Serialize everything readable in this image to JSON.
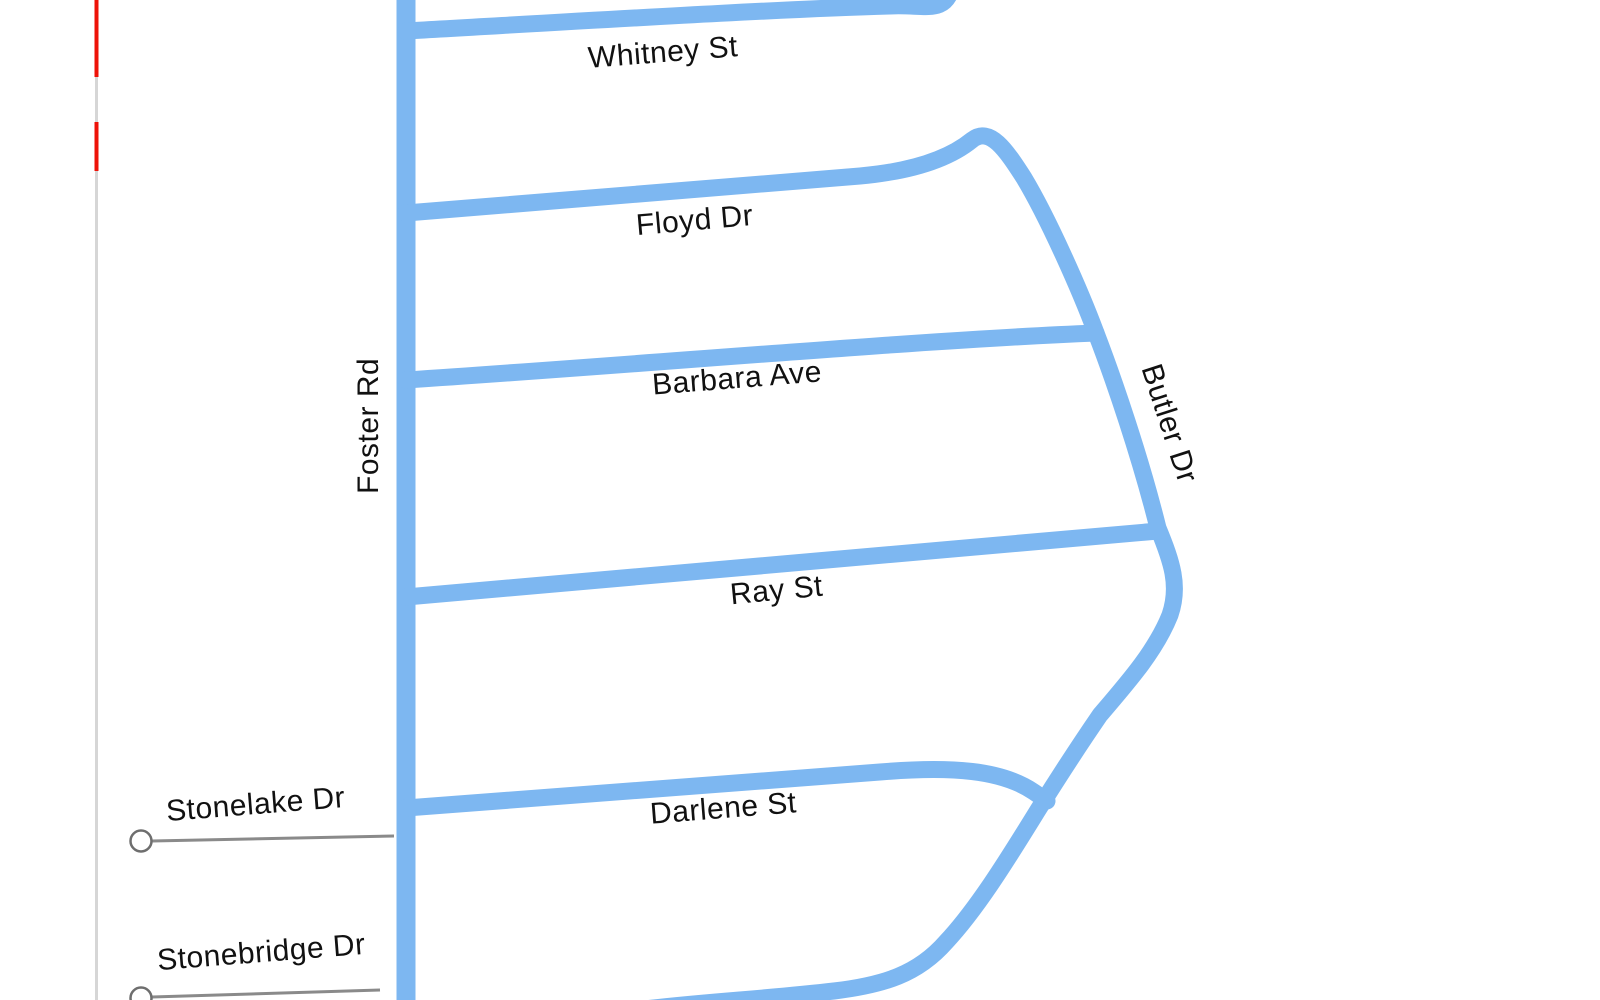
{
  "map": {
    "type": "street-map",
    "background": "#ffffff",
    "colors": {
      "road": "#7db7f1",
      "boundary_gray": "#d6d6d6",
      "boundary_red": "#ee1208",
      "callout_line": "#8a8a8a",
      "circle_stroke": "#6e6e6e",
      "circle_fill": "#ffffff",
      "label_text": "#111111"
    },
    "streets": {
      "whitney": {
        "label": "Whitney St"
      },
      "floyd": {
        "label": "Floyd Dr"
      },
      "barbara": {
        "label": "Barbara Ave"
      },
      "ray": {
        "label": "Ray St"
      },
      "darlene": {
        "label": "Darlene St"
      },
      "foster": {
        "label": "Foster Rd"
      },
      "butler": {
        "label": "Butler Dr"
      },
      "stonelake": {
        "label": "Stonelake Dr"
      },
      "stonebridge": {
        "label": "Stonebridge Dr"
      }
    }
  }
}
